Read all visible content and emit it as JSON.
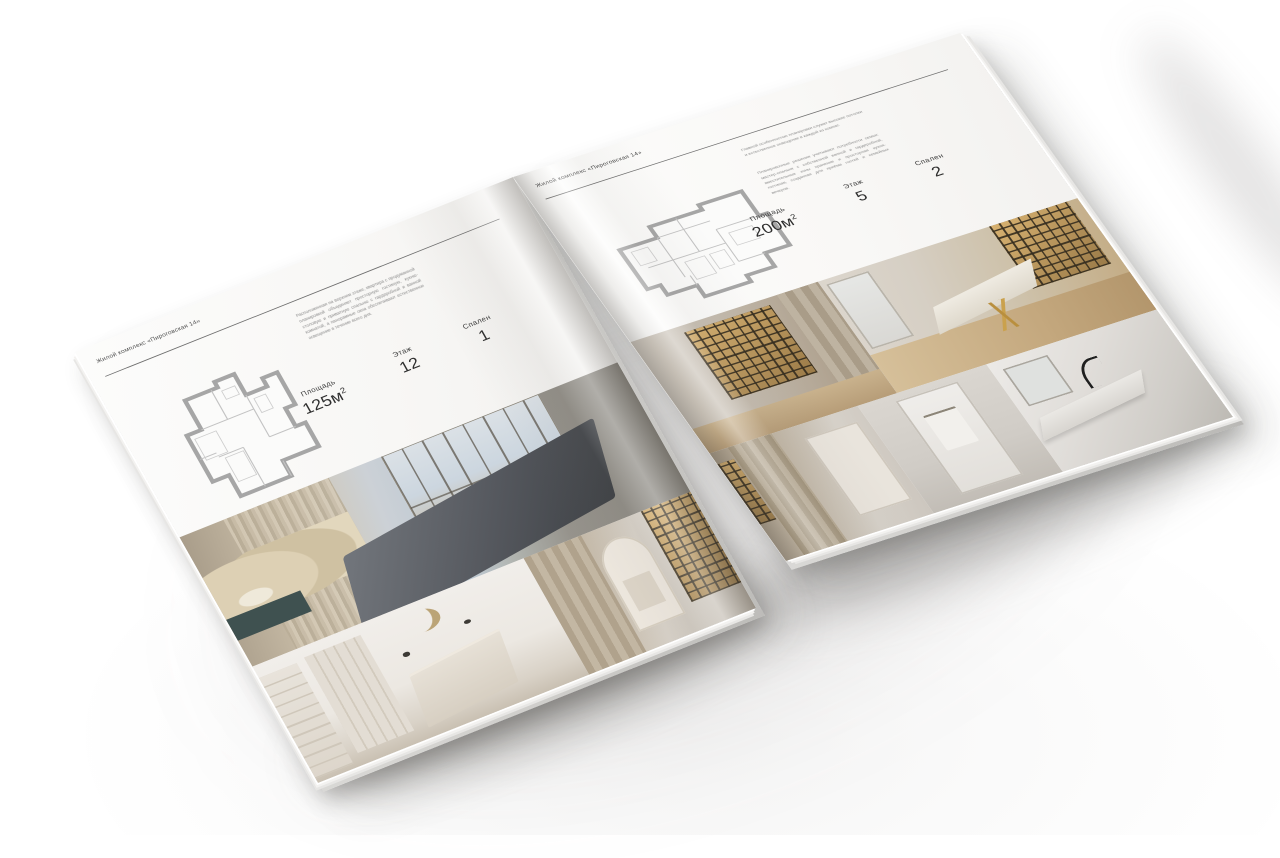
{
  "background_color": "#ffffff",
  "brochure": {
    "left_page": {
      "header": "Жилой комплекс «Пироговская 14»",
      "description": "Расположенная на верхнем этаже, квартира с продуманной планировкой объединяет просторную гостиную, кухню-столовую и приватную спальню с гардеробной и ванной комнатой, а панорамные окна обеспечивают естественное освещение в течение всего дня.",
      "specs": {
        "area_label": "Площадь",
        "area_value": "125м",
        "area_sup": "2",
        "floor_label": "Этаж",
        "floor_value": "12",
        "bedrooms_label": "Спален",
        "bedrooms_value": "1"
      },
      "photos": [
        "master-bedroom-panorama",
        "white-bedroom",
        "hallway-with-shelving"
      ]
    },
    "right_page": {
      "header": "Жилой комплекс «Пироговская 14»",
      "description_1": "Главной особенностью планировки служат высокие потолки и естественное освещение в каждой из комнат.",
      "description_2": "Планировочные решения учитывают потребности семьи: мастер-спальня с собственной ванной и гардеробной, вместительные зоны хранения и просторная кухня-гостиная, созданная для приёма гостей и семейных вечеров.",
      "specs": {
        "area_label": "Площадь",
        "area_value": "200м",
        "area_sup": "2",
        "floor_label": "Этаж",
        "floor_value": "5",
        "bedrooms_label": "Спален",
        "bedrooms_value": "2"
      },
      "photos": [
        "lit-wardrobe-room",
        "home-office",
        "corridor-wardrobe",
        "door-with-towel",
        "bathroom-counter"
      ]
    }
  }
}
